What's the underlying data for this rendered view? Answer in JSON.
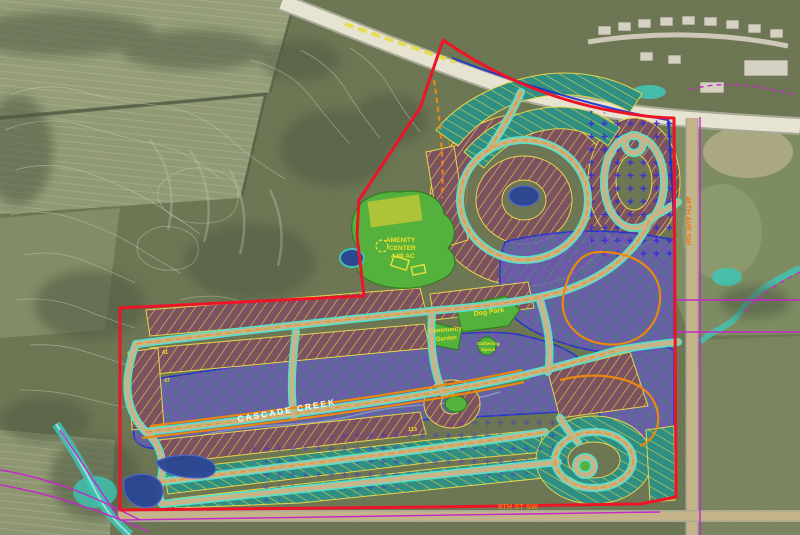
{
  "labels": {
    "creek_name": "CASCADE CREEK",
    "dog_park": "Dog Park",
    "community_garden_l1": "Community",
    "community_garden_l2": "Garden",
    "gathering_l1": "Gathering",
    "gathering_l2": "Space",
    "amenity_l1": "AMENITY",
    "amenity_l2": "CENTER",
    "amenity_l3": "4.88 AC",
    "ave_46": "46TH AVE SW",
    "st_9": "9TH ST SW",
    "block_41": "41",
    "block_47": "47",
    "block_113": "113"
  },
  "colors": {
    "boundary": "#ee1428",
    "parcel_line": "#c428c8",
    "floodplain_fill": "#5a66a6",
    "floodplain_edge": "#2438c8",
    "floodplain_hatch": "#8a3fd0",
    "road_edge": "#52e2cf",
    "road_fill": "#c7b488",
    "centerline": "#e8941c",
    "trail": "#e8880f",
    "lot_fill": "#7c5260",
    "lot_fill_teal": "#2f8f82",
    "lot_line": "#e8d44a",
    "park_green": "#54b23c",
    "park_label": "#f2e028",
    "street_label": "#e87d12",
    "water": "#2a4494",
    "creek": "#3cc4b4",
    "highway": "#ebe6d4",
    "field": "#939c74",
    "terrain": "#69734f",
    "trees": "#49553c",
    "contour": "#ccd1bc",
    "marker_dots": "#3a2fd4",
    "house": "#d8d3c4"
  }
}
